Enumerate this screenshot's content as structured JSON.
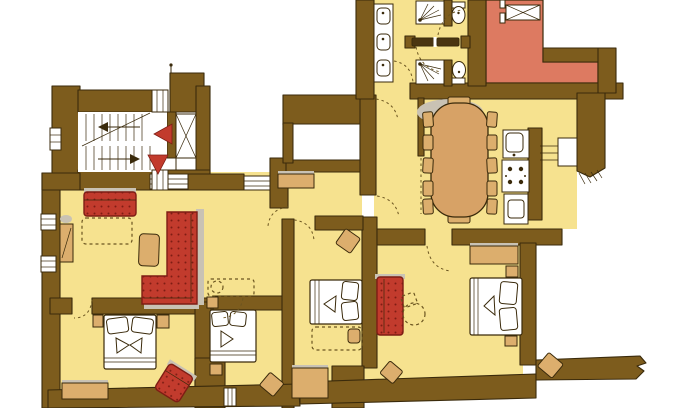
{
  "type": "floor-plan",
  "title": "apartment-floor-plan",
  "colors": {
    "wall": "#7d5c1d",
    "ink": "#3a2a0b",
    "floor": "#f6e28f",
    "salmon": "#dd7a61",
    "red": "#c23b2d",
    "red_dark": "#7e1d14",
    "tan": "#dcae6d",
    "table": "#d7a266",
    "shadow": "#c9c2b4",
    "dash": "#6b5520"
  },
  "rooms": [
    "stairwell",
    "elevator",
    "entry-hall",
    "living-room",
    "bathroom-upper",
    "bathroom-lower",
    "washbasin-area",
    "utility-room",
    "dining-room",
    "kitchen",
    "bedroom-left",
    "bedroom-middle",
    "bedroom-center",
    "bedroom-right"
  ],
  "fixtures": [
    "stairs-up",
    "stairs-down",
    "elevator-cab",
    "direction-triangles",
    "washbasins",
    "shower",
    "toilet",
    "kitchen-sink",
    "stove",
    "base-unit",
    "steps-niche",
    "window",
    "door-swing"
  ],
  "furniture": [
    "two-seat-sofa",
    "corner-sofa",
    "coffee-table",
    "side-cabinet",
    "hall-sideboard",
    "dining-table",
    "dining-chairs",
    "double-bed",
    "optional-bed-dotted",
    "nightstand",
    "stool",
    "dresser",
    "desk",
    "red-armchair",
    "red-settee",
    "bench"
  ]
}
